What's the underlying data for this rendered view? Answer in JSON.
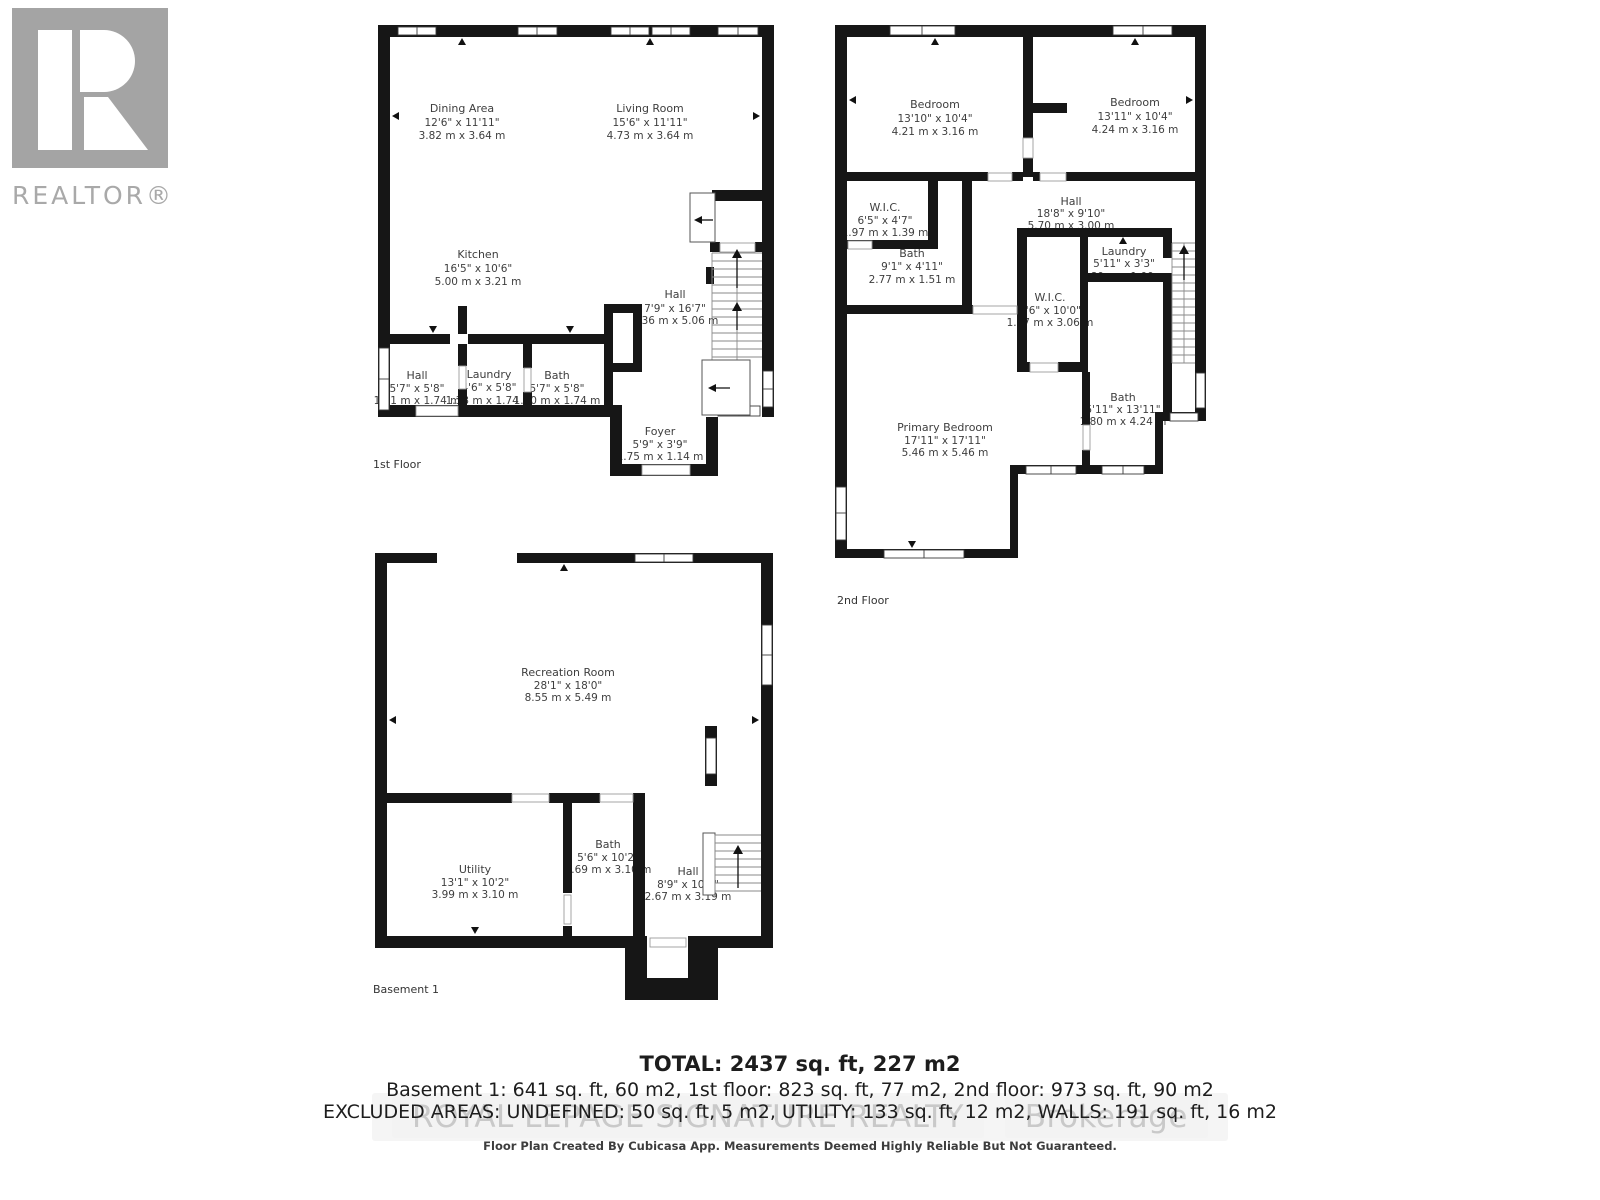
{
  "branding": {
    "realtor_wordmark": "REALTOR®",
    "media": {
      "monogram_a": "A",
      "monogram_m": "M",
      "caption": "ALLISON MEDIA CO."
    },
    "colors": {
      "wall_black": "#161616",
      "label_text": "#3e3e3e",
      "realtor_gray": "#a6a6a6",
      "media_green": "#3d5345",
      "watermark_gray": "#c9c9c9"
    }
  },
  "floors": {
    "first": {
      "caption": "1st Floor",
      "rooms": {
        "dining": {
          "name": "Dining Area",
          "imperial": "12'6\" x 11'11\"",
          "metric": "3.82 m x 3.64 m"
        },
        "living": {
          "name": "Living Room",
          "imperial": "15'6\" x 11'11\"",
          "metric": "4.73 m x 3.64 m"
        },
        "kitchen": {
          "name": "Kitchen",
          "imperial": "16'5\" x 10'6\"",
          "metric": "5.00 m x 3.21 m"
        },
        "hall": {
          "name": "Hall",
          "imperial": "7'9\" x 16'7\"",
          "metric": "2.36 m x 5.06 m"
        },
        "hall_small": {
          "name": "Hall",
          "imperial": "5'7\" x 5'8\"",
          "metric": "1.71 m x 1.74 m"
        },
        "laundry": {
          "name": "Laundry",
          "imperial": "4'6\" x 5'8\"",
          "metric": "1.38 m x 1.74 m"
        },
        "bath": {
          "name": "Bath",
          "imperial": "5'7\" x 5'8\"",
          "metric": "1.70 m x 1.74 m"
        },
        "foyer": {
          "name": "Foyer",
          "imperial": "5'9\" x 3'9\"",
          "metric": "1.75 m x 1.14 m"
        }
      }
    },
    "second": {
      "caption": "2nd Floor",
      "rooms": {
        "bedroom_left": {
          "name": "Bedroom",
          "imperial": "13'10\" x 10'4\"",
          "metric": "4.21 m x 3.16 m"
        },
        "bedroom_right": {
          "name": "Bedroom",
          "imperial": "13'11\" x 10'4\"",
          "metric": "4.24 m x 3.16 m"
        },
        "wic": {
          "name": "W.I.C.",
          "imperial": "6'5\" x 4'7\"",
          "metric": "1.97 m x 1.39 m"
        },
        "hall": {
          "name": "Hall",
          "imperial": "18'8\" x 9'10\"",
          "metric": "5.70 m x 3.00 m"
        },
        "bath": {
          "name": "Bath",
          "imperial": "9'1\" x 4'11\"",
          "metric": "2.77 m x 1.51 m"
        },
        "laundry": {
          "name": "Laundry",
          "imperial": "5'11\" x 3'3\"",
          "metric": "1.80 m x 1.00 m"
        },
        "wic2": {
          "name": "W.I.C.",
          "imperial": "4'6\" x 10'0\"",
          "metric": "1.37 m x 3.06 m"
        },
        "bath2": {
          "name": "Bath",
          "imperial": "5'11\" x 13'11\"",
          "metric": "1.80 m x 4.24 m"
        },
        "primary": {
          "name": "Primary Bedroom",
          "imperial": "17'11\" x 17'11\"",
          "metric": "5.46 m x 5.46 m"
        }
      }
    },
    "basement": {
      "caption": "Basement 1",
      "rooms": {
        "recreation": {
          "name": "Recreation Room",
          "imperial": "28'1\" x 18'0\"",
          "metric": "8.55 m x 5.49 m"
        },
        "utility": {
          "name": "Utility",
          "imperial": "13'1\" x 10'2\"",
          "metric": "3.99 m x 3.10 m"
        },
        "bath": {
          "name": "Bath",
          "imperial": "5'6\" x 10'2\"",
          "metric": "1.69 m x 3.10 m"
        },
        "hall": {
          "name": "Hall",
          "imperial": "8'9\" x 10'6\"",
          "metric": "2.67 m x 3.19 m"
        }
      }
    }
  },
  "summary": {
    "total": "TOTAL: 2437 sq. ft, 227 m2",
    "floors_line": "Basement 1: 641 sq. ft, 60 m2, 1st floor: 823 sq. ft, 77 m2, 2nd floor: 973 sq. ft, 90 m2",
    "excluded_line": "EXCLUDED AREAS: UNDEFINED: 50 sq. ft, 5 m2, UTILITY: 133 sq. ft, 12 m2, WALLS: 191 sq. ft, 16 m2",
    "watermark_realty": "ROYAL LEPAGE SIGNATURE REALTY",
    "watermark_brokerage": "Brokerage",
    "disclaimer": "Floor Plan Created By Cubicasa App. Measurements Deemed Highly Reliable But Not Guaranteed."
  }
}
